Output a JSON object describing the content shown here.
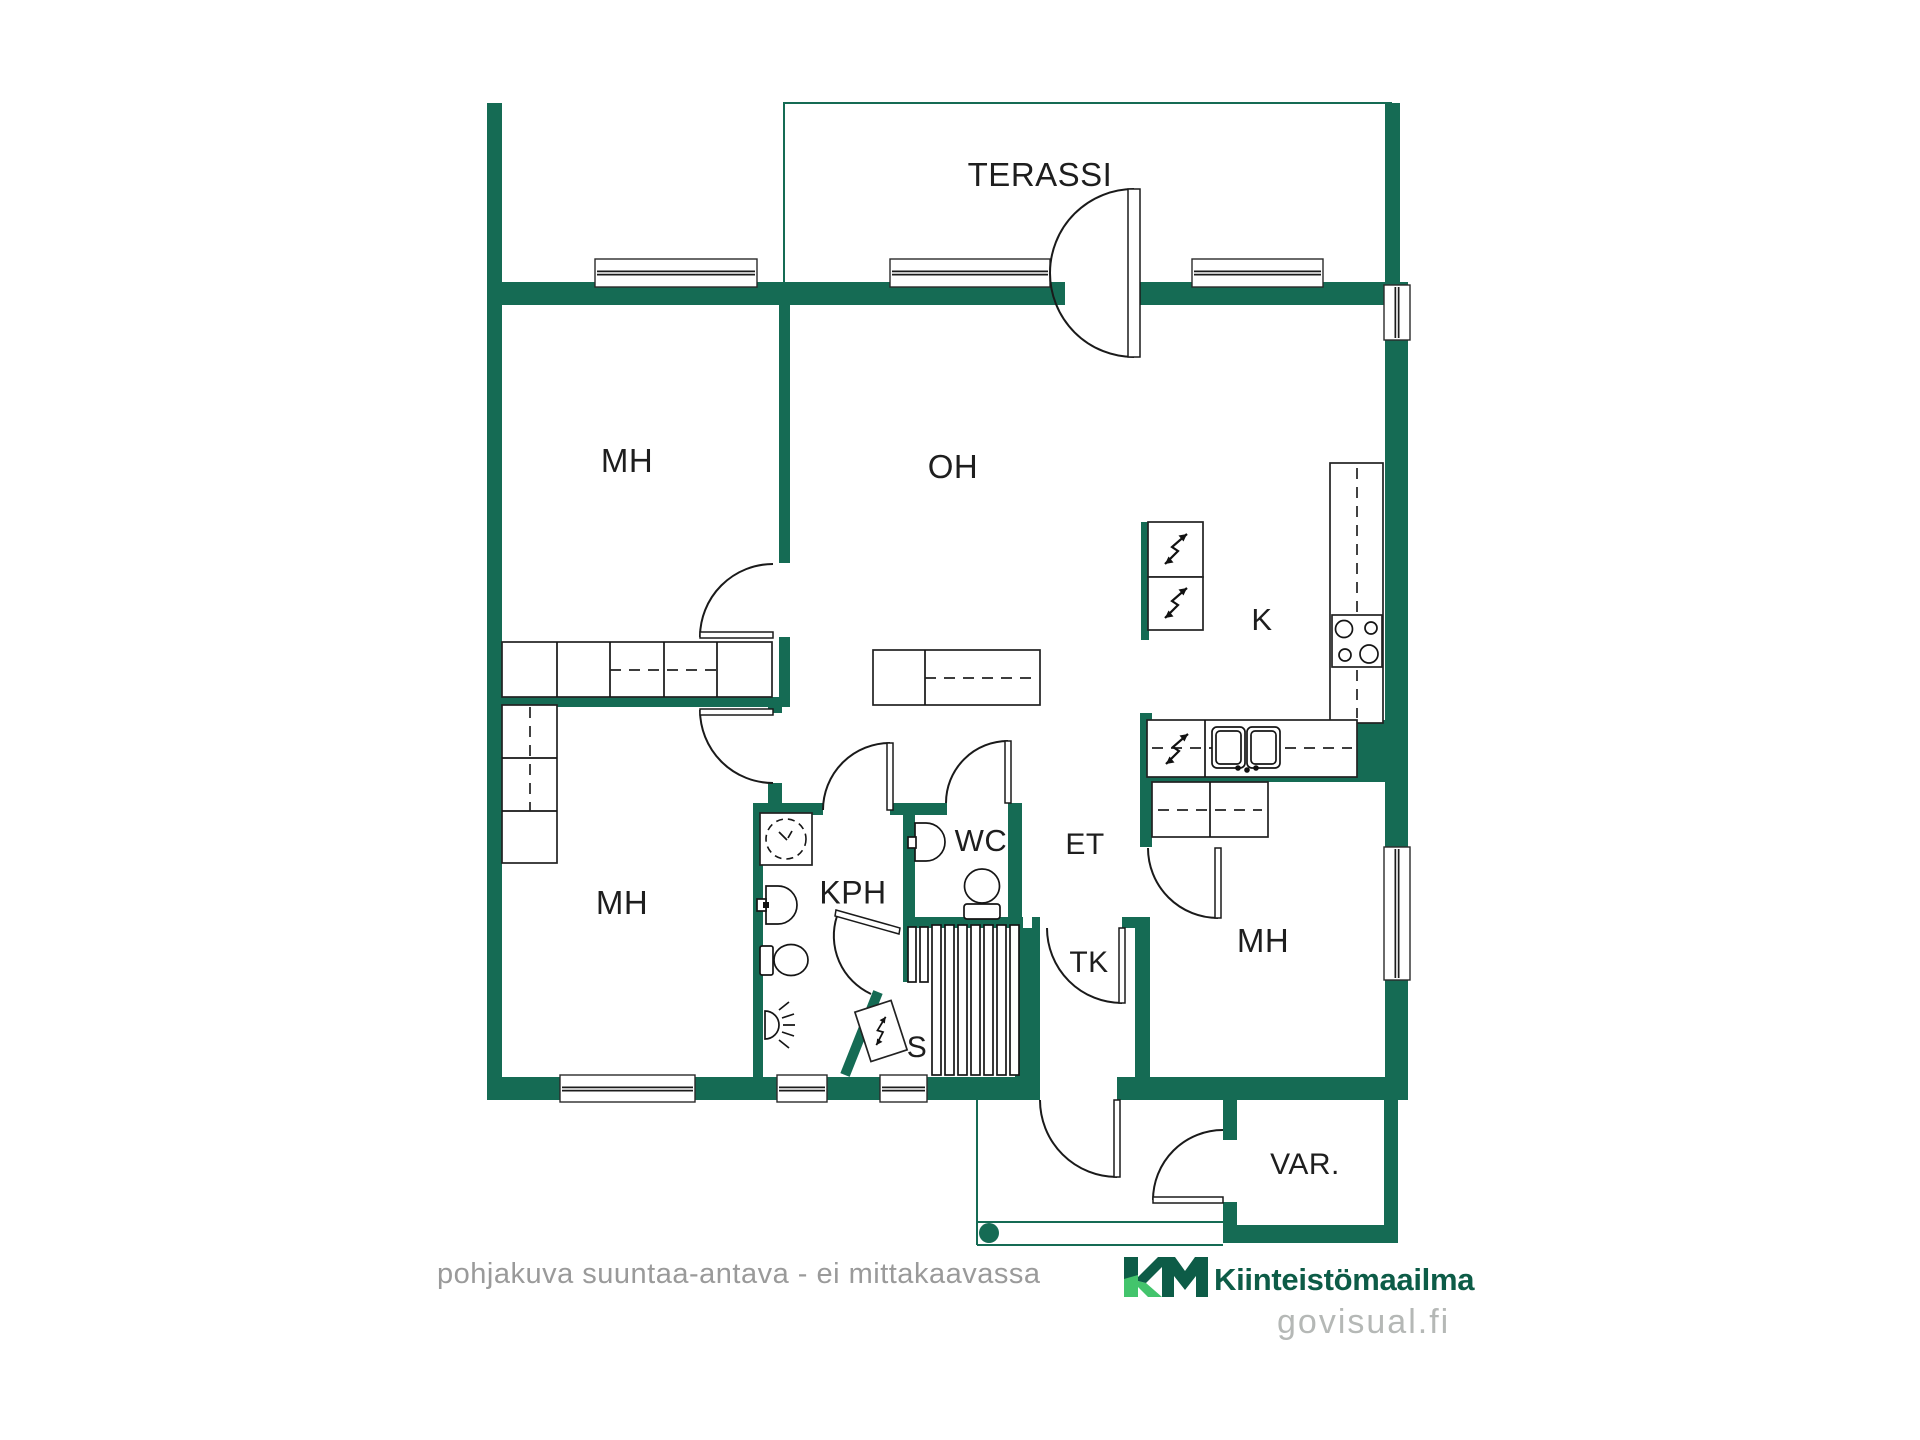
{
  "floorplan": {
    "rooms": {
      "terassi": {
        "label": "TERASSI"
      },
      "mh1": {
        "label": "MH"
      },
      "oh": {
        "label": "OH"
      },
      "k": {
        "label": "K"
      },
      "mh2": {
        "label": "MH"
      },
      "kph": {
        "label": "KPH"
      },
      "wc": {
        "label": "WC"
      },
      "et": {
        "label": "ET"
      },
      "tk": {
        "label": "TK"
      },
      "s": {
        "label": "S"
      },
      "mh3": {
        "label": "MH"
      },
      "var": {
        "label": "VAR."
      }
    },
    "footer": {
      "disclaimer": "pohjakuva suuntaa-antava - ei mittakaavassa"
    },
    "branding": {
      "monogram": "KM",
      "company": "Kiinteistömaailma",
      "watermark": "govisual.fi"
    },
    "colors": {
      "wall_green": "#156b54",
      "logo_dark_green": "#0d5c47",
      "logo_light_green": "#43c46c",
      "label_text": "#1e1e1e",
      "muted_gray": "#9a9a9a",
      "watermark_gray": "#b5b8b6"
    }
  }
}
